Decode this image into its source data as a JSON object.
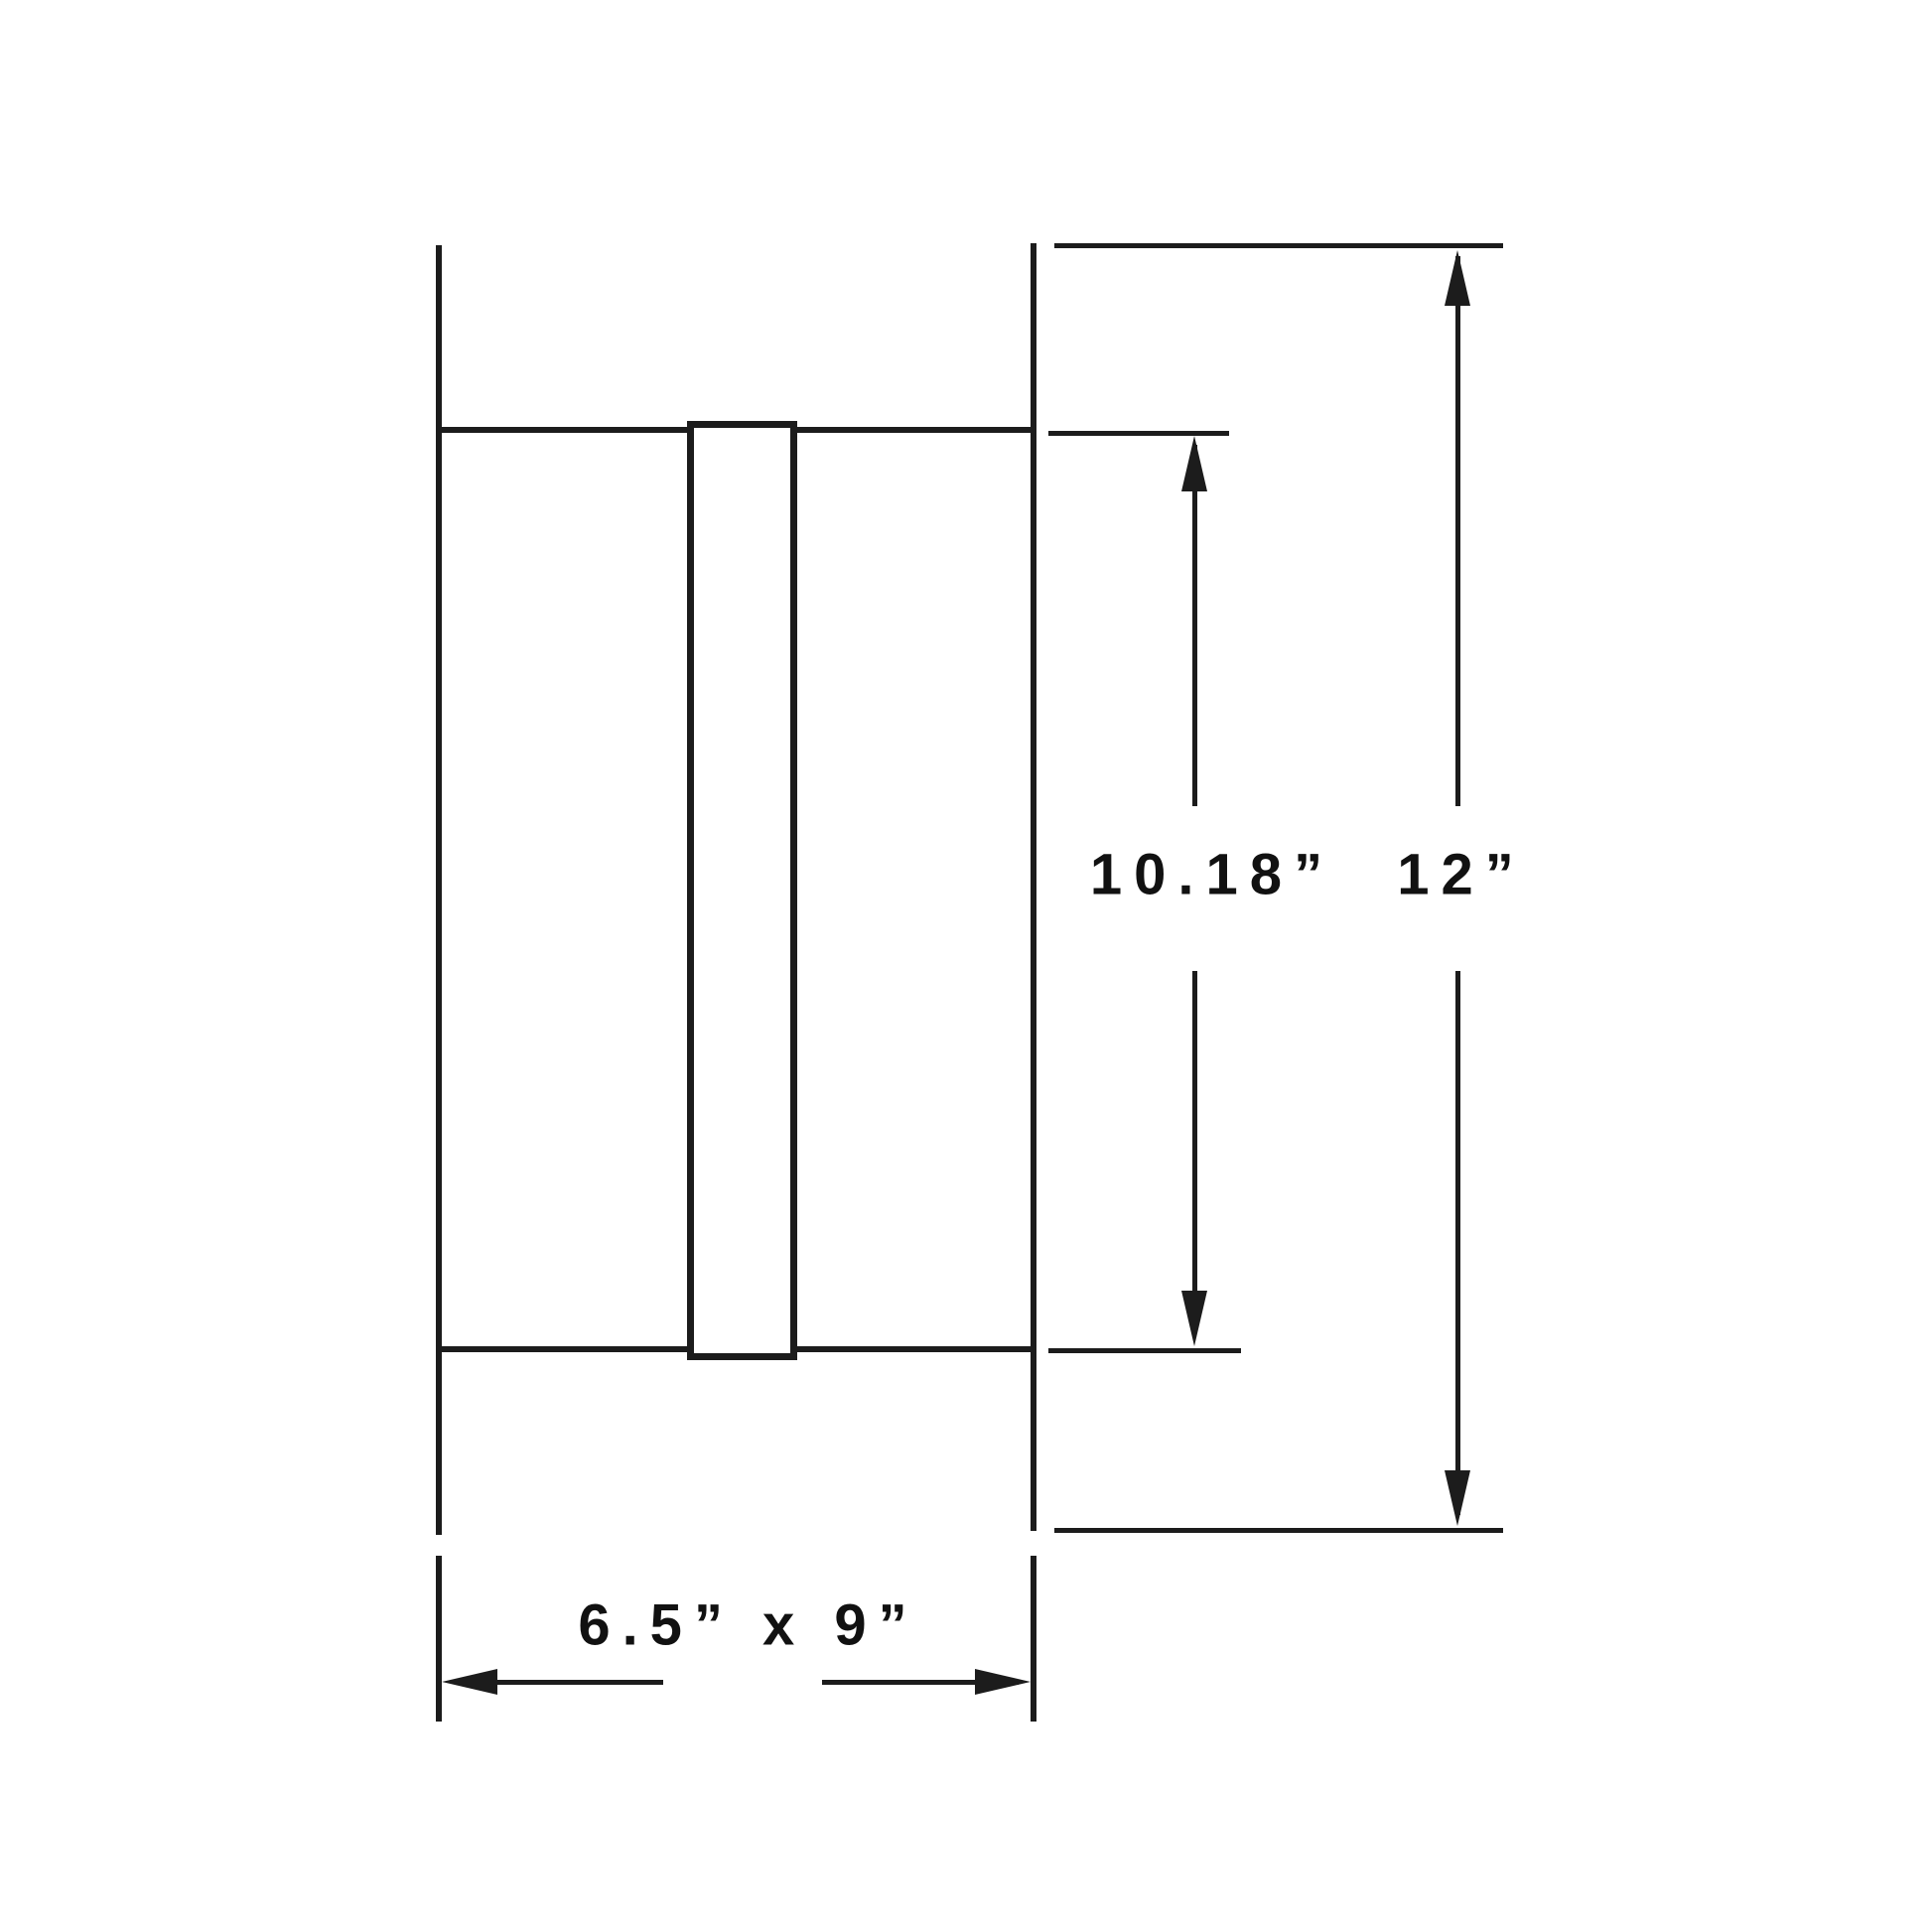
{
  "drawing": {
    "background": "#ffffff",
    "line_color": "#1c1c1c",
    "text_color": "#111111",
    "labels": {
      "inner_height": "10.18”",
      "outer_height": "12”",
      "duct_size": "6.5” x 9”"
    }
  }
}
